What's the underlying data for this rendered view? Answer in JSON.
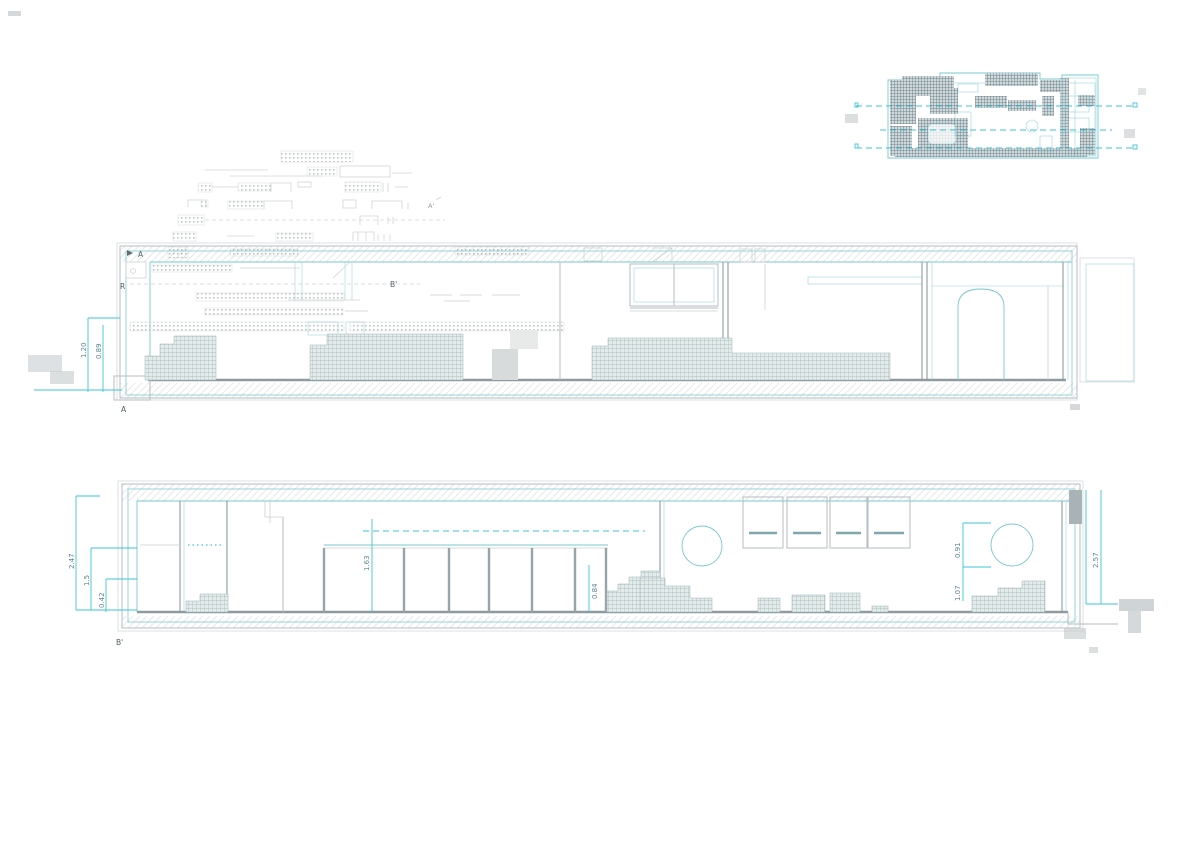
{
  "colors": {
    "teal": "#7ac7d2",
    "cyan": "#3ec3d8",
    "gray_line": "#b6bec2",
    "gray_dark": "#8d9ba1",
    "faint": "#ccd0d2",
    "text": "#4f5f66",
    "dim_text": "#5d8791",
    "hatch_line": "#9cb4b6",
    "smudge": "#c3c9cc"
  },
  "upper_section": {
    "markers": {
      "top_left": "A",
      "left": "R",
      "mid": "B'",
      "overlay": "A'",
      "bottom_left": "A"
    },
    "dims": {
      "left_1": "1.20",
      "left_2": "0.89"
    }
  },
  "lower_section": {
    "markers": {
      "bottom_left": "B'"
    },
    "dims": {
      "left_1": "2.47",
      "left_2": "1.5",
      "left_3": "0.42",
      "glazing": "1.63",
      "steps": "0.84",
      "circle_width": "0.91",
      "circle_height": "1.07",
      "right_height": "2.57"
    }
  }
}
